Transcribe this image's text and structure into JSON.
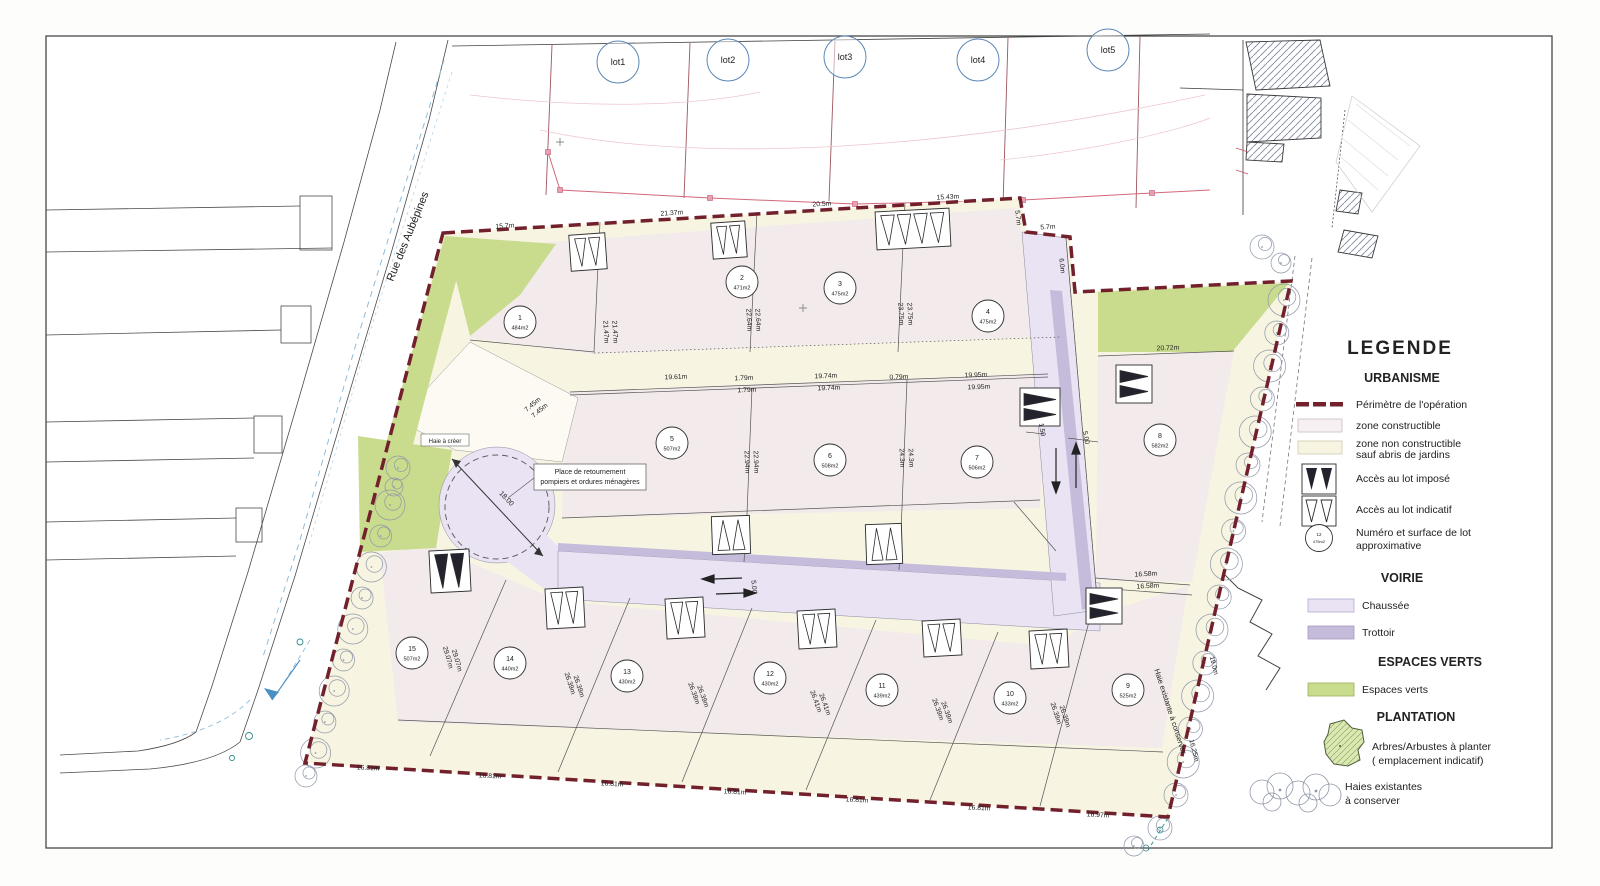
{
  "legend": {
    "title": "LEGENDE",
    "sections": [
      {
        "heading": "URBANISME",
        "items": [
          {
            "lines": [
              "Périmètre de l'opération"
            ]
          },
          {
            "lines": [
              "zone constructible"
            ]
          },
          {
            "lines": [
              "zone non constructible",
              "sauf abris de jardins"
            ]
          },
          {
            "lines": [
              "Accès au lot imposé"
            ]
          },
          {
            "lines": [
              "Accès au lot indicatif"
            ]
          },
          {
            "lines": [
              "Numéro et surface de lot",
              "approximative"
            ]
          }
        ]
      },
      {
        "heading": "VOIRIE",
        "items": [
          {
            "lines": [
              "Chaussée"
            ]
          },
          {
            "lines": [
              "Trottoir"
            ]
          }
        ]
      },
      {
        "heading": "ESPACES VERTS",
        "items": [
          {
            "lines": [
              "Espaces verts"
            ]
          }
        ]
      },
      {
        "heading": "PLANTATION",
        "items": [
          {
            "lines": [
              "Arbres/Arbustes à planter",
              "( emplacement indicatif)"
            ]
          },
          {
            "lines": [
              "Haies existantes",
              "à conserver"
            ]
          }
        ]
      }
    ],
    "lot_symbol": {
      "num": "12",
      "area": "475m2"
    }
  },
  "map": {
    "street_name": "Rue des Aubépines",
    "labels": {
      "haie_a_creer": "Haie à créer",
      "place_line1": "Place de retournement",
      "place_line2": "pompiers et ordures ménagères",
      "turning_diameter": "18.00",
      "haie_existante": "Haie existante à conserver"
    },
    "existing_lots": [
      {
        "label": "lot1",
        "x": 618,
        "y": 62
      },
      {
        "label": "lot2",
        "x": 728,
        "y": 60
      },
      {
        "label": "lot3",
        "x": 845,
        "y": 57
      },
      {
        "label": "lot4",
        "x": 978,
        "y": 60
      },
      {
        "label": "lot5",
        "x": 1108,
        "y": 50
      }
    ],
    "lots": [
      {
        "num": "1",
        "area": "484m2",
        "x": 520,
        "y": 322
      },
      {
        "num": "2",
        "area": "471m2",
        "x": 742,
        "y": 282
      },
      {
        "num": "3",
        "area": "475m2",
        "x": 840,
        "y": 288
      },
      {
        "num": "4",
        "area": "475m2",
        "x": 988,
        "y": 316
      },
      {
        "num": "5",
        "area": "507m2",
        "x": 672,
        "y": 443
      },
      {
        "num": "6",
        "area": "508m2",
        "x": 830,
        "y": 460
      },
      {
        "num": "7",
        "area": "506m2",
        "x": 977,
        "y": 462
      },
      {
        "num": "8",
        "area": "582m2",
        "x": 1160,
        "y": 440
      },
      {
        "num": "9",
        "area": "525m2",
        "x": 1128,
        "y": 690
      },
      {
        "num": "10",
        "area": "433m2",
        "x": 1010,
        "y": 698
      },
      {
        "num": "11",
        "area": "439m2",
        "x": 882,
        "y": 690
      },
      {
        "num": "12",
        "area": "430m2",
        "x": 770,
        "y": 678
      },
      {
        "num": "13",
        "area": "430m2",
        "x": 627,
        "y": 676
      },
      {
        "num": "14",
        "area": "440m2",
        "x": 510,
        "y": 663
      },
      {
        "num": "15",
        "area": "507m2",
        "x": 412,
        "y": 653
      }
    ],
    "dimension_labels": [
      {
        "t": "15.7m",
        "x": 505,
        "y": 228,
        "r": -4
      },
      {
        "t": "21.37m",
        "x": 672,
        "y": 215,
        "r": -4
      },
      {
        "t": "20.5m",
        "x": 822,
        "y": 206,
        "r": -3
      },
      {
        "t": "15.43m",
        "x": 948,
        "y": 199,
        "r": -3
      },
      {
        "t": "5.7m",
        "x": 1016,
        "y": 218,
        "r": 84
      },
      {
        "t": "5.7m",
        "x": 1048,
        "y": 229,
        "r": -4
      },
      {
        "t": "6.0m",
        "x": 1060,
        "y": 266,
        "r": 84
      },
      {
        "t": "20.72m",
        "x": 1168,
        "y": 350,
        "r": -2
      },
      {
        "t": "16.58m",
        "x": 1146,
        "y": 576,
        "r": -3
      },
      {
        "t": "16.58m",
        "x": 1148,
        "y": 588,
        "r": -3
      },
      {
        "t": "21.47m",
        "x": 604,
        "y": 332,
        "r": 87
      },
      {
        "t": "21.47m",
        "x": 613,
        "y": 332,
        "r": 87
      },
      {
        "t": "22.64m",
        "x": 747,
        "y": 320,
        "r": 87
      },
      {
        "t": "22.64m",
        "x": 756,
        "y": 320,
        "r": 87
      },
      {
        "t": "23.75m",
        "x": 899,
        "y": 314,
        "r": 87
      },
      {
        "t": "23.75m",
        "x": 908,
        "y": 314,
        "r": 87
      },
      {
        "t": "19.61m",
        "x": 676,
        "y": 379,
        "r": -2
      },
      {
        "t": "1.79m",
        "x": 744,
        "y": 380,
        "r": -2
      },
      {
        "t": "1.79m",
        "x": 747,
        "y": 392,
        "r": -2
      },
      {
        "t": "19.74m",
        "x": 826,
        "y": 378,
        "r": -2
      },
      {
        "t": "19.74m",
        "x": 829,
        "y": 390,
        "r": -2
      },
      {
        "t": "0.79m",
        "x": 899,
        "y": 379,
        "r": -2
      },
      {
        "t": "19.95m",
        "x": 976,
        "y": 377,
        "r": -2
      },
      {
        "t": "19.95m",
        "x": 979,
        "y": 389,
        "r": -2
      },
      {
        "t": "22.94m",
        "x": 745,
        "y": 462,
        "r": 88
      },
      {
        "t": "22.94m",
        "x": 754,
        "y": 462,
        "r": 88
      },
      {
        "t": "24.3m",
        "x": 900,
        "y": 458,
        "r": 88
      },
      {
        "t": "24.3m",
        "x": 909,
        "y": 458,
        "r": 88
      },
      {
        "t": "7.45m",
        "x": 534,
        "y": 406,
        "r": -40
      },
      {
        "t": "7.45m",
        "x": 541,
        "y": 412,
        "r": -40
      },
      {
        "t": "1.50",
        "x": 1040,
        "y": 430,
        "r": 80
      },
      {
        "t": "5.00",
        "x": 1084,
        "y": 438,
        "r": 80
      },
      {
        "t": "5.00",
        "x": 752,
        "y": 587,
        "r": 85
      },
      {
        "t": "29.07m",
        "x": 446,
        "y": 658,
        "r": 74
      },
      {
        "t": "29.07m",
        "x": 455,
        "y": 661,
        "r": 74
      },
      {
        "t": "26.39m",
        "x": 568,
        "y": 684,
        "r": 72
      },
      {
        "t": "26.39m",
        "x": 577,
        "y": 687,
        "r": 72
      },
      {
        "t": "26.39m",
        "x": 692,
        "y": 694,
        "r": 70
      },
      {
        "t": "26.39m",
        "x": 701,
        "y": 697,
        "r": 70
      },
      {
        "t": "26.41m",
        "x": 814,
        "y": 702,
        "r": 70
      },
      {
        "t": "26.41m",
        "x": 823,
        "y": 705,
        "r": 70
      },
      {
        "t": "26.39m",
        "x": 936,
        "y": 710,
        "r": 70
      },
      {
        "t": "26.39m",
        "x": 945,
        "y": 713,
        "r": 70
      },
      {
        "t": "26.39m",
        "x": 1054,
        "y": 714,
        "r": 72
      },
      {
        "t": "26.39m",
        "x": 1063,
        "y": 717,
        "r": 72
      },
      {
        "t": "16.81m",
        "x": 368,
        "y": 770,
        "r": 3
      },
      {
        "t": "16.81m",
        "x": 490,
        "y": 778,
        "r": 3
      },
      {
        "t": "16.81m",
        "x": 612,
        "y": 786,
        "r": 3
      },
      {
        "t": "16.81m",
        "x": 735,
        "y": 794,
        "r": 3
      },
      {
        "t": "16.81m",
        "x": 857,
        "y": 802,
        "r": 3
      },
      {
        "t": "16.81m",
        "x": 979,
        "y": 810,
        "r": 3
      },
      {
        "t": "16.97m",
        "x": 1098,
        "y": 817,
        "r": 3
      },
      {
        "t": "19.0m",
        "x": 1212,
        "y": 666,
        "r": 76
      },
      {
        "t": "16.25m",
        "x": 1192,
        "y": 751,
        "r": 76
      }
    ]
  },
  "colors": {
    "perimeter": "#72212c",
    "zone_constructible": "#f3eaeb",
    "zone_non_constructible": "#f7f4e2",
    "chaussee": "#e9e3f3",
    "trottoir": "#c5bbdb",
    "espaces_verts": "#c9dc8e",
    "existing_lot_blue": "#4a7fb5",
    "cadastre_red": "#c45a6a"
  }
}
